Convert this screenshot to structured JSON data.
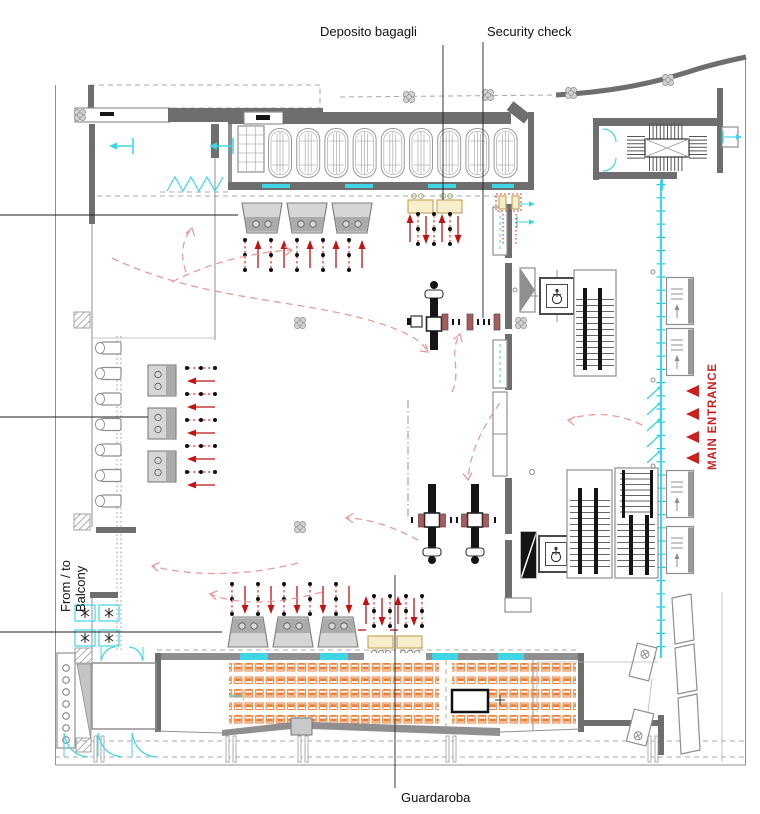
{
  "labels": {
    "deposito_bagagli": "Deposito bagagli",
    "security_check": "Security check",
    "guardaroba": "Guardaroba",
    "from_to_balcony": {
      "line1": "From / to",
      "line2": "Balcony"
    },
    "main_entrance": "MAIN ENTRANCE"
  },
  "colors": {
    "wall": "#6e6e6e",
    "glazing": "#3fd5e5",
    "queue_red": "#c41212",
    "flow_pink": "#e59c9c",
    "tan_fill": "#f7eecb",
    "tan_border": "#c9a65f",
    "orange": "#e8803a",
    "desk_fill": "#d6d6d6",
    "desk_dark": "#ababab",
    "gate_red": "#a35f5f",
    "entrance_red": "#cc1f1f"
  },
  "icons": {
    "main_entrance_arrow": "red-left-triangle",
    "wheelchair": "accessible-lift-symbol",
    "stairs": "stair-tread-hatch",
    "door": "cyan-door-swing",
    "queue": "red-arrow-with-dot-line",
    "turnstile": "security-gate-symbol",
    "column": "clover-column"
  }
}
